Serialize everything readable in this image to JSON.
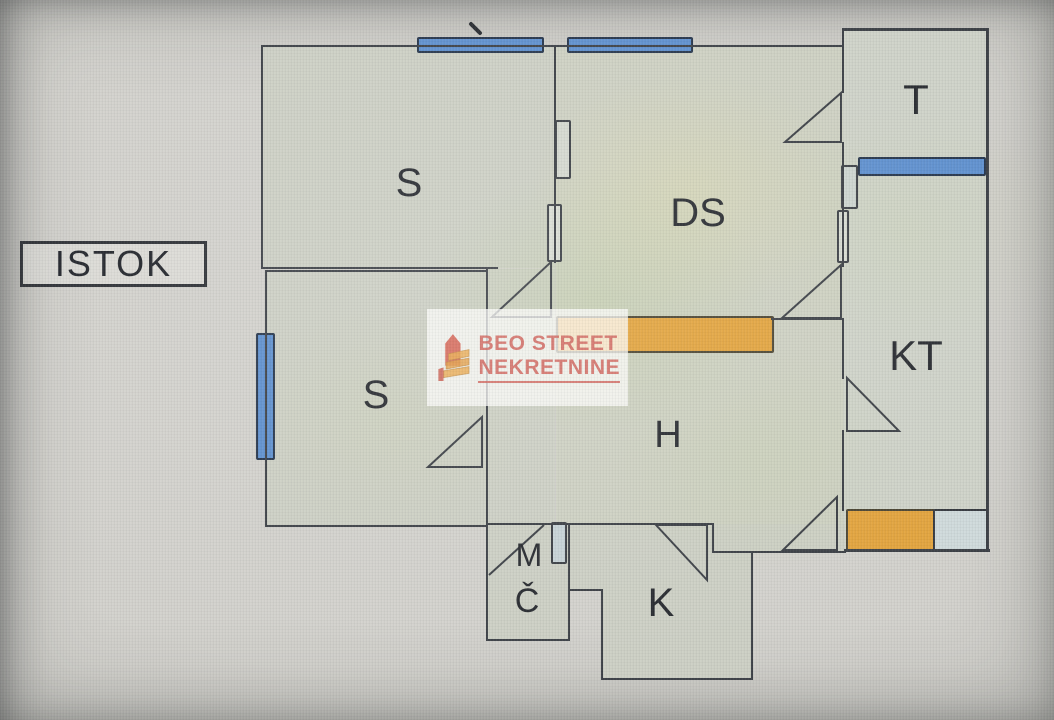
{
  "plan": {
    "orientation_label": "ISTOK",
    "rooms": {
      "bedroom_top": "S",
      "bedroom_bottom": "S",
      "living_room": "DS",
      "toilet": "T",
      "bathroom": "KT",
      "hallway": "H",
      "bath_m": "M",
      "bath_c": "Č",
      "kitchen": "K"
    },
    "watermark": {
      "line1": "BEO STREET",
      "line2": "NEKRETNINE"
    },
    "colors": {
      "wall": "#3a3e44",
      "window_blue": "#5d8fce",
      "accent_orange": "#e2a33c",
      "pale_blue": "#cfdadb",
      "brand_red": "#ce6058",
      "interior_fill": "#cccfc4",
      "background": "#d2d1cc"
    }
  }
}
